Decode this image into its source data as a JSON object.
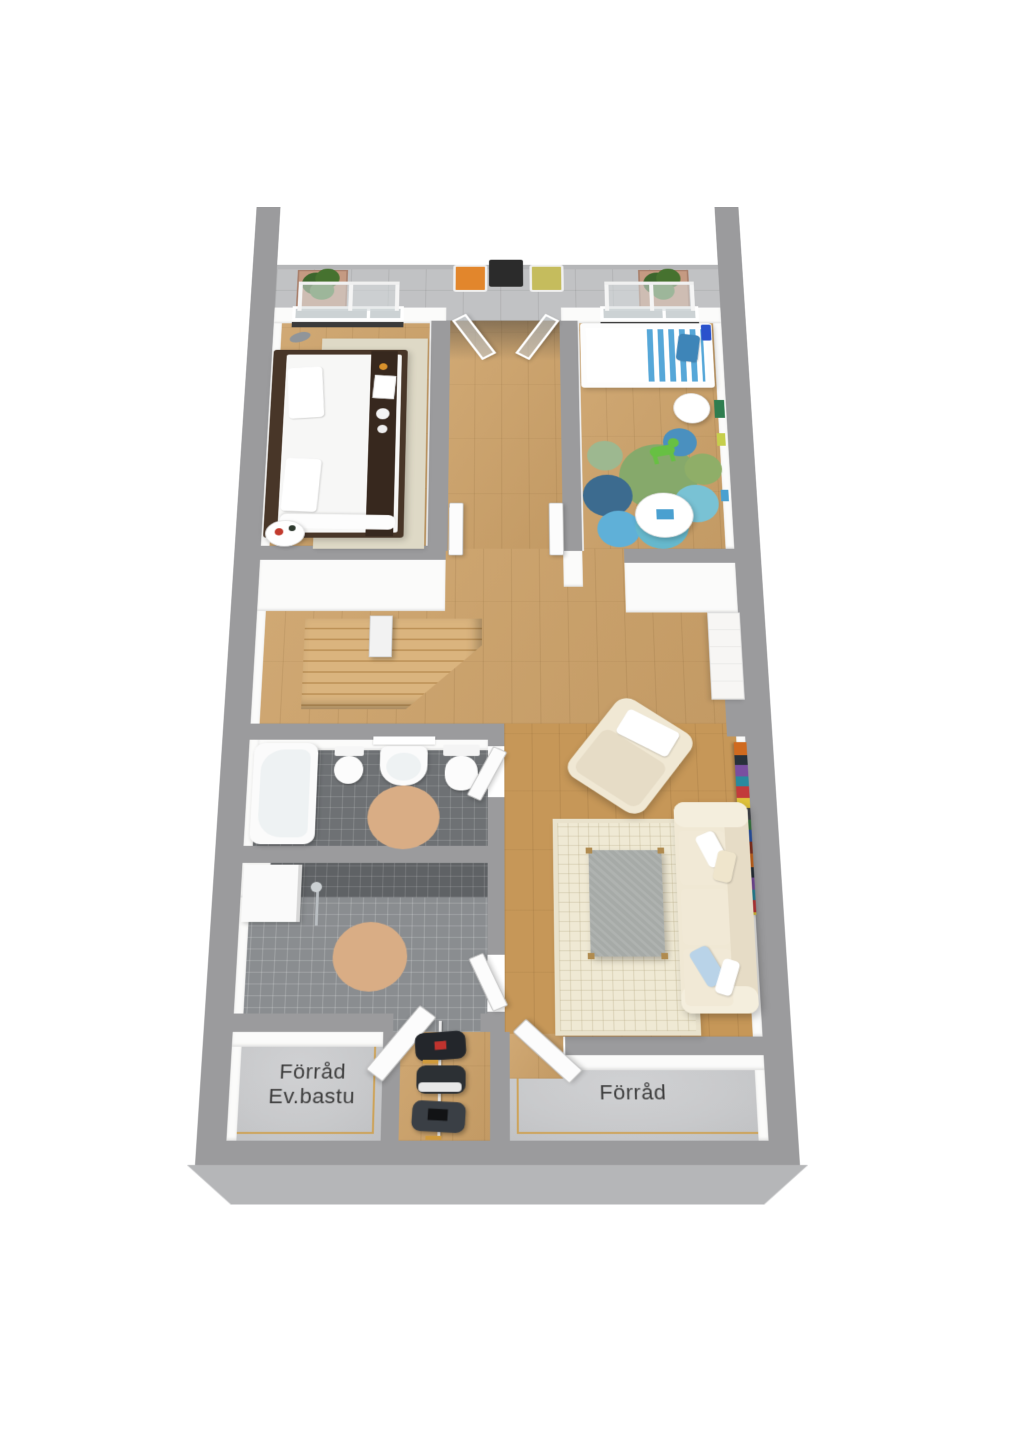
{
  "title": "3D apartment floor plan render",
  "labels": {
    "storage_left_line1": "Förråd",
    "storage_left_line2": "Ev.bastu",
    "storage_right": "Förråd"
  },
  "rooms": [
    "balcony",
    "bedroom",
    "kids-room",
    "hallway",
    "stairs",
    "bathroom",
    "shower-room",
    "living-room",
    "closet",
    "storage-ev-bastu",
    "storage"
  ],
  "colors": {
    "wall": "#9b9b9d",
    "wall-light": "#b5b6b8",
    "face": "#fbfbfa",
    "wood": "#cda269",
    "wood-living": "#c69758",
    "wood-stairs": "#dab47e",
    "tile-balcony": "#c1c2c4",
    "bath-floor": "#6e7174",
    "shower-floor": "#8a8d90",
    "dark-tile": "#5f6265",
    "concrete": "#c8c9cb",
    "trim": "#cf9a3c",
    "rug": "#efe9d4",
    "rug-round": "#d9ad85",
    "rug-bedroom": "#ded9c6",
    "cream": "#f0e8d4",
    "cream-dark": "#e6dcc6",
    "table-gray": "#a6aaa7",
    "bed-frame": "#483628",
    "runner": "#37281e",
    "stripe-blue": "#56a7d8",
    "pillow-blue": "#b9d3e8",
    "plant": "#46722f",
    "pot": "#c59a82",
    "chair-orange": "#e2862c",
    "chair-yellow": "#c5bc5d",
    "toy-green": "#67c043",
    "label": "#3d3d3d"
  }
}
